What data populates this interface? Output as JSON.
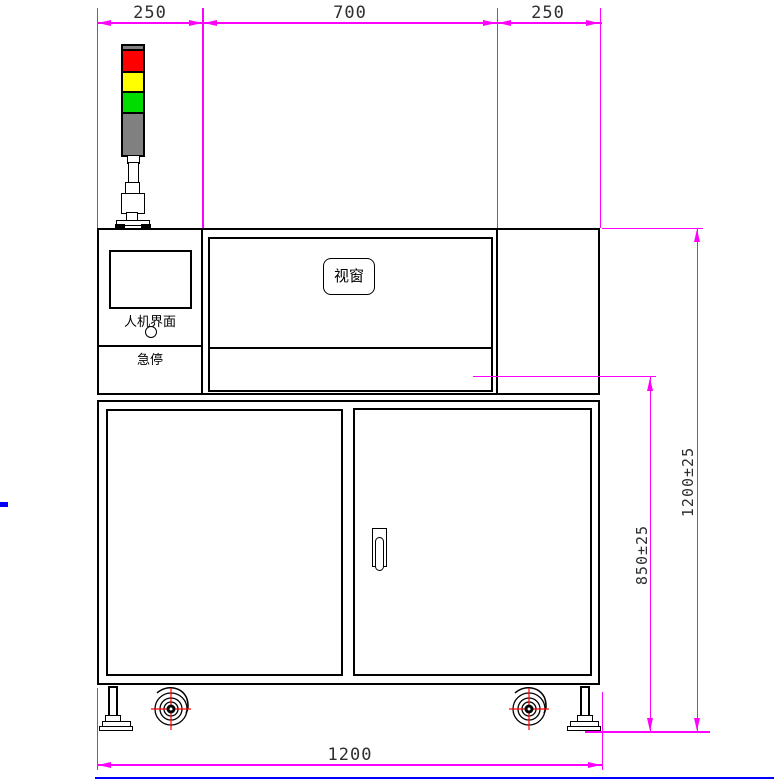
{
  "colors": {
    "dimension": "#FF00FF",
    "outline": "#000000",
    "text": "#2E2E2E",
    "background": "#FFFFFF",
    "blue_marker": "#0000FF",
    "red": "#FF0000",
    "yellow": "#FFFF00",
    "green": "#00DB00",
    "gray": "#808080",
    "caster_cross": "#FF0000"
  },
  "dimensions": {
    "top_left": "250",
    "top_middle": "700",
    "top_right": "250",
    "overall_height": "1200±25",
    "cabinet_height": "850±25",
    "overall_width": "1200"
  },
  "labels": {
    "hmi": "人机界面",
    "estop": "急停",
    "viewport": "视窗"
  },
  "tower_light": {
    "segments": [
      {
        "name": "red",
        "color": "#FF0000"
      },
      {
        "name": "yellow",
        "color": "#FFFF00"
      },
      {
        "name": "green",
        "color": "#00DB00"
      }
    ],
    "cap_color": "#808080",
    "body_color": "#808080"
  }
}
